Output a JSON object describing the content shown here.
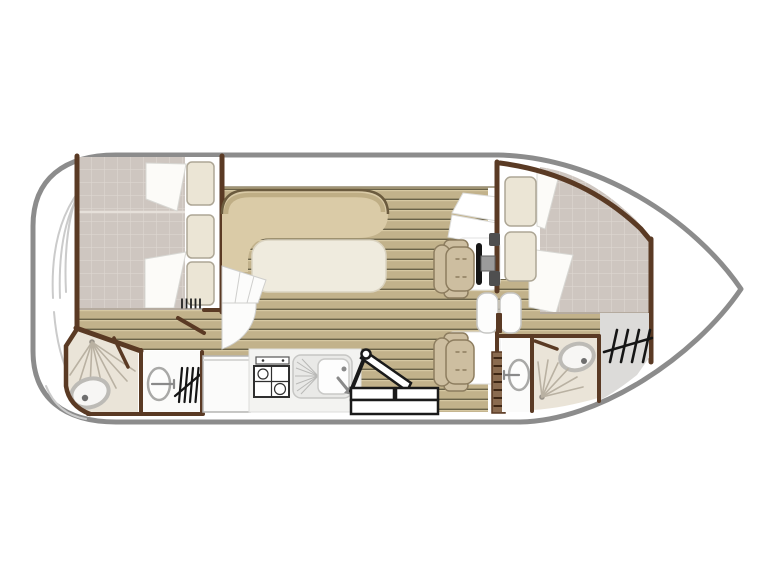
{
  "diagram": {
    "label": "Motor cruiser boat floor plan, top view",
    "rooms": [
      {
        "id": "bow-deck",
        "fixtures": [
          "curved-deck-lines"
        ]
      },
      {
        "id": "front-cabin",
        "fixtures": [
          "double-berth",
          "three-pillows",
          "folded-blankets",
          "heater-vent",
          "cabin-door"
        ]
      },
      {
        "id": "front-bathroom",
        "fixtures": [
          "shower-spray",
          "shower-screen",
          "toilet",
          "washbasin",
          "heater"
        ]
      },
      {
        "id": "saloon",
        "fixtures": [
          "l-shaped-bench",
          "table",
          "entry-steps"
        ]
      },
      {
        "id": "galley",
        "fixtures": [
          "refrigerator",
          "two-burner-stove",
          "sink-with-drainer",
          "control-panel"
        ]
      },
      {
        "id": "companionway",
        "fixtures": [
          "folding-step-ladder",
          "step-boxes"
        ]
      },
      {
        "id": "helm-station",
        "fixtures": [
          "steering-wheel",
          "instrument-knobs",
          "pilot-seat",
          "co-pilot-seat",
          "double-door",
          "side-ladder"
        ]
      },
      {
        "id": "rear-cabin",
        "fixtures": [
          "double-berth",
          "two-pillows",
          "folded-blanket"
        ]
      },
      {
        "id": "rear-bathroom",
        "fixtures": [
          "washbasin",
          "toilet",
          "shower-spray",
          "shower-door"
        ]
      },
      {
        "id": "stern-deck",
        "fixtures": [
          "heater"
        ]
      }
    ]
  },
  "colors": {
    "page_bg": "#ffffff",
    "hull_outline": "#8C8C8C",
    "wall": "#5A3A24",
    "wood_base": "#C2B28B",
    "wood_shadow": "#6A6248",
    "wood_highlight": "#D6C8A2",
    "bench": "#DACBA7",
    "bench_stripe": "#BFAE85",
    "bench_edge": "#6B5B3E",
    "table": "#EFEBDE",
    "mattress": "#CEC6C0",
    "mattress_grid": "#DDD6D0",
    "pillow": "#EBE5D5",
    "pillow_edge": "#ADA695",
    "seat": "#CDBEA0",
    "seat_edge": "#8D7D5F",
    "counter": "#F3F3F1",
    "steel": "#E9E9E7",
    "deck_gray": "#DCDBD9",
    "bath_floor": "#EAE4D8",
    "spray": "#B9B1A2",
    "fixture_rim": "#BDBBB6",
    "ink": "#1A1A1A",
    "deck_line": "#CBCBCB",
    "white": "#FFFFFF"
  }
}
